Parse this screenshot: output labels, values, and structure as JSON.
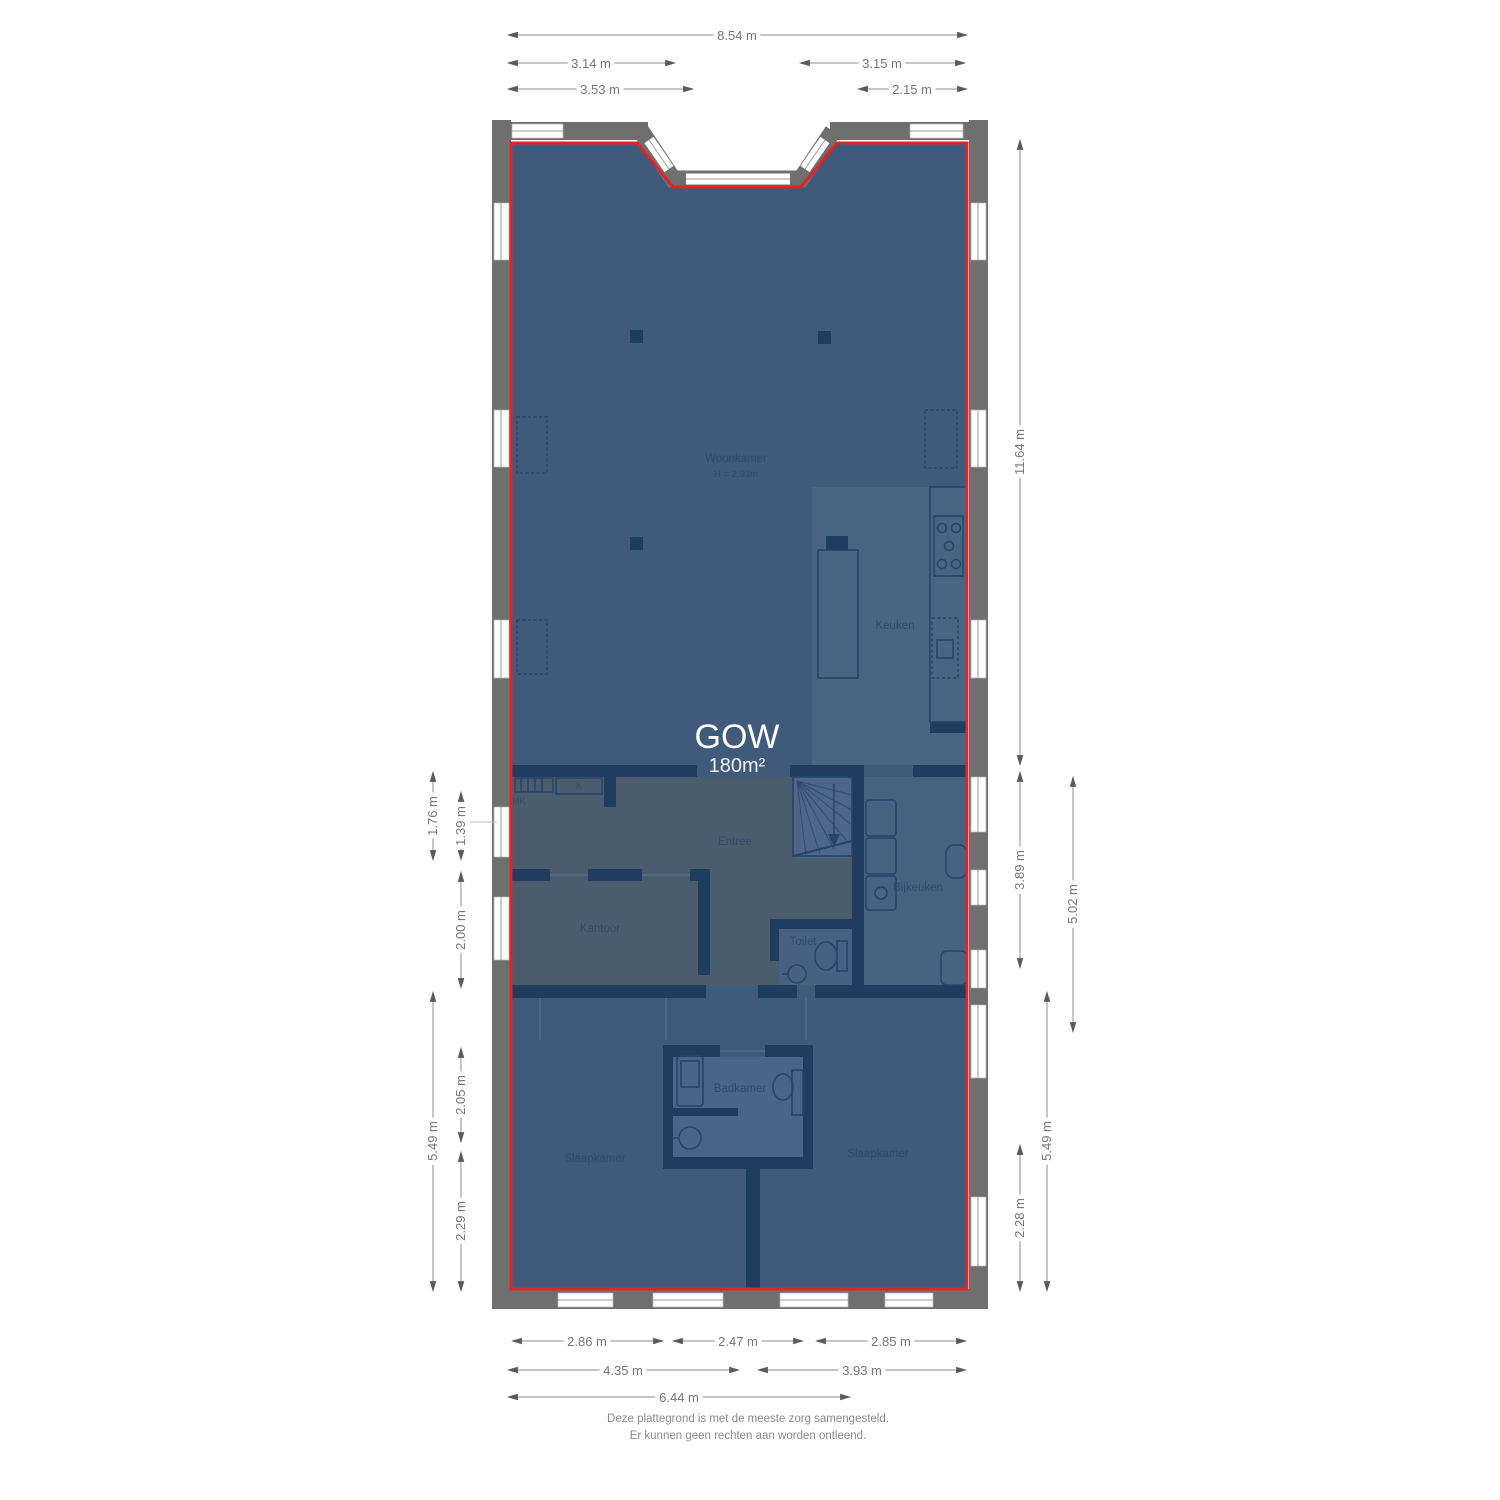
{
  "overlay": {
    "title": "GOW",
    "area": "180m²"
  },
  "rooms": {
    "woonkamer": {
      "label": "Woonkamer",
      "height_note": "H = 2.93m"
    },
    "keuken": {
      "label": "Keuken"
    },
    "entree": {
      "label": "Entree"
    },
    "kantoor": {
      "label": "Kantoor"
    },
    "bijkeuken": {
      "label": "Bijkeuken"
    },
    "toilet": {
      "label": "Toilet"
    },
    "badkamer": {
      "label": "Badkamer"
    },
    "slaapkamer_links": {
      "label": "Slaapkamer"
    },
    "slaapkamer_rechts": {
      "label": "Slaapkamer"
    },
    "meterkast": {
      "label": "MK"
    },
    "kast": {
      "label": "K"
    }
  },
  "dimensions": {
    "top": [
      "8.54 m",
      "3.14 m",
      "3.15 m",
      "3.53 m",
      "2.15 m"
    ],
    "bottom": [
      "2.86 m",
      "2.47 m",
      "2.85 m",
      "4.35 m",
      "3.93 m",
      "6.44 m"
    ],
    "left": [
      "1.76 m",
      "1.39 m",
      "2.00 m",
      "5.49 m",
      "2.05 m",
      "2.29 m"
    ],
    "right": [
      "11.64 m",
      "3.89 m",
      "5.02 m",
      "5.49 m",
      "2.28 m"
    ]
  },
  "footer": {
    "line1": "Deze plattegrond is met de meeste zorg samengesteld.",
    "line2": "Er kunnen geen rechten aan worden ontleend."
  },
  "colors": {
    "boundary_red": "#e02423",
    "wall_exterior": "#6f6f70",
    "wall_interior": "#1f3d5e",
    "floor_dark": "#3f5a7a",
    "floor_light": "#4a6484",
    "floor_gray": "#4b5c6d",
    "label_text": "#2b4a6d",
    "dim_text": "#767676"
  }
}
